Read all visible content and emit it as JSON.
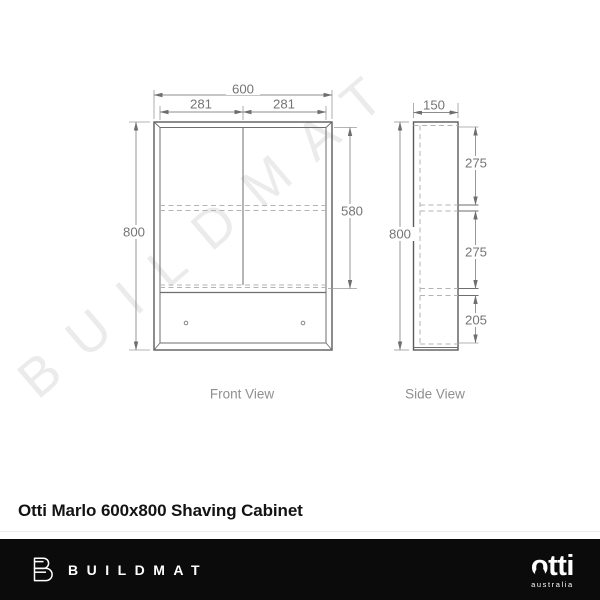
{
  "watermark": {
    "text": "BUILDMAT"
  },
  "product": {
    "title": "Otti Marlo 600x800 Shaving Cabinet"
  },
  "drawing": {
    "front": {
      "label": "Front View",
      "overall_width": "600",
      "left_door_width": "281",
      "right_door_width": "281",
      "overall_height": "800",
      "door_height": "580"
    },
    "side": {
      "label": "Side View",
      "depth": "150",
      "overall_height": "800",
      "top_section": "275",
      "middle_section": "275",
      "bottom_section": "205"
    }
  },
  "footer": {
    "buildmat_wordmark": "BUILDMAT",
    "otti_wordmark": "otti",
    "otti_subtext": "australia"
  },
  "colors": {
    "drawing_line": "#5a5a5a",
    "dimension_line": "#8c8c8c",
    "dimension_text": "#757575",
    "watermark": "#ebebeb",
    "footer_background": "#0b0b0b",
    "footer_text": "#ffffff"
  }
}
